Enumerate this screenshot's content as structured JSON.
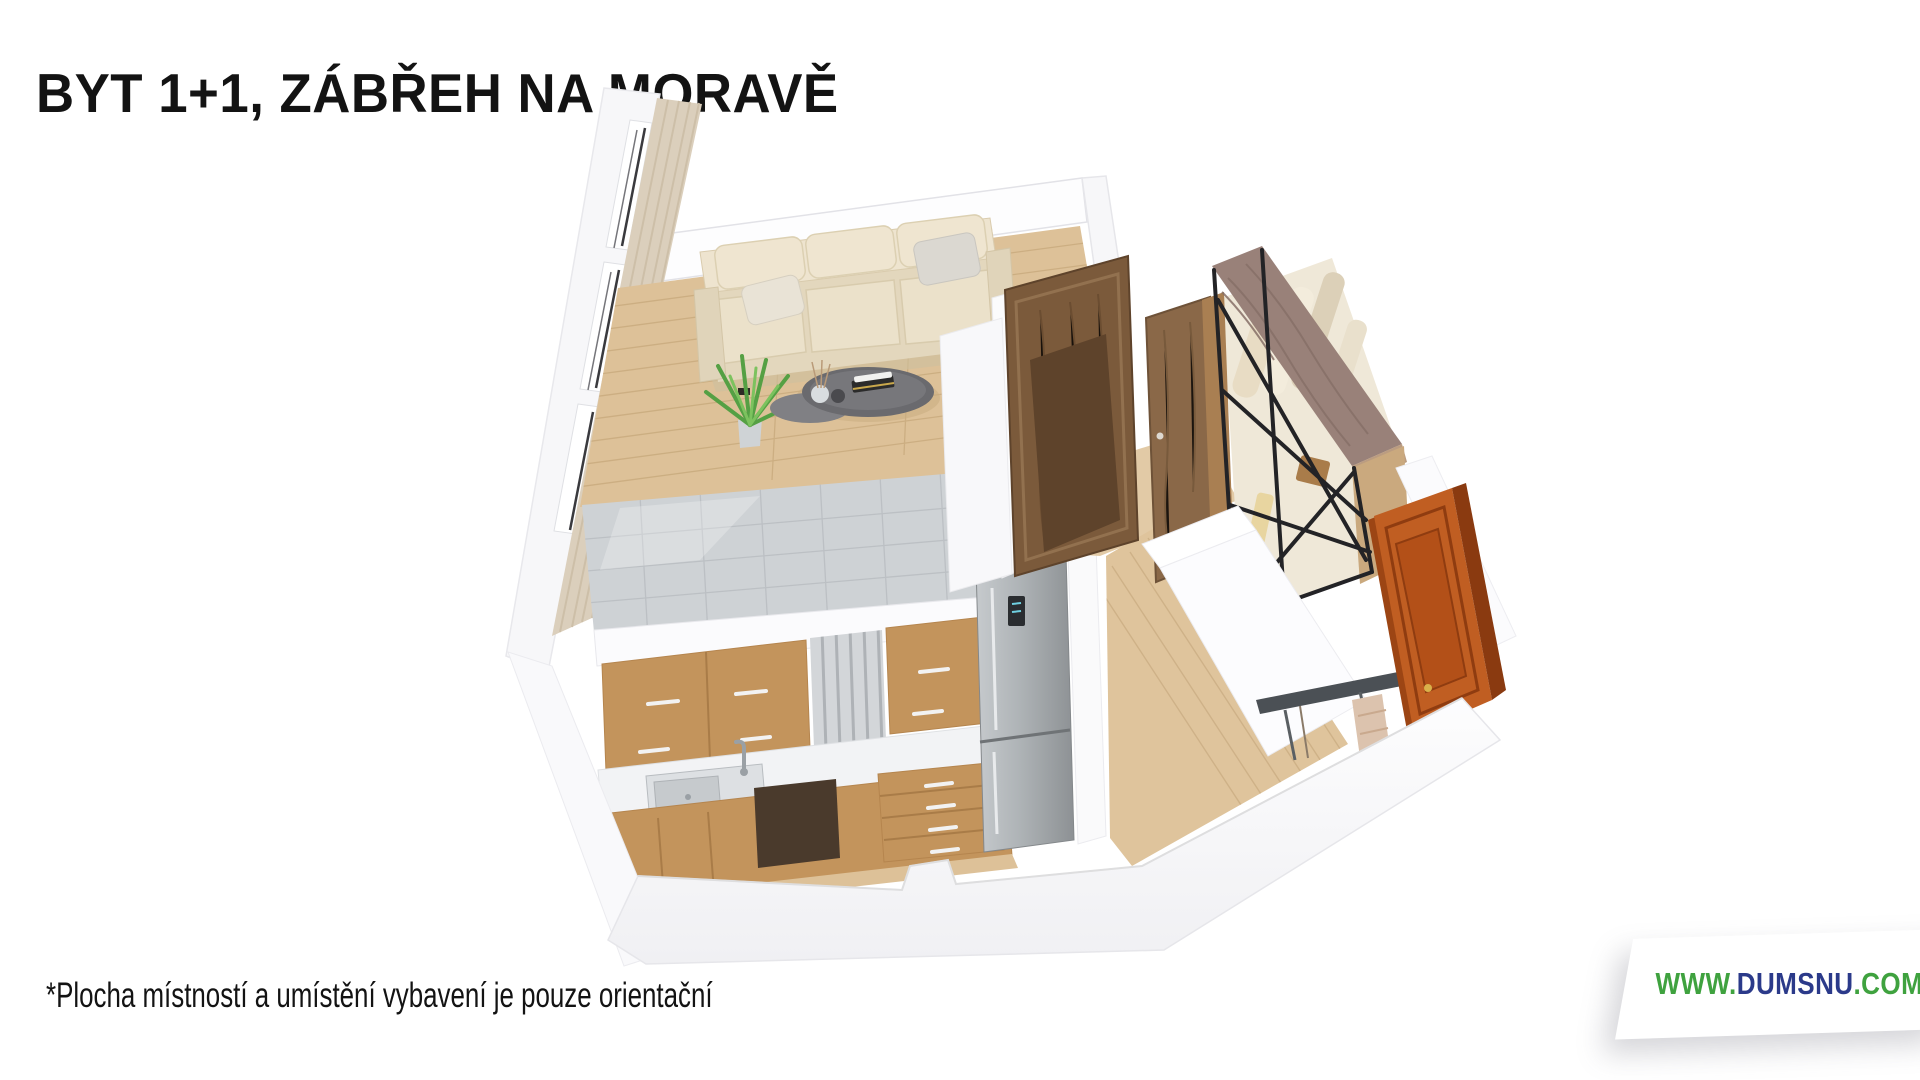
{
  "page": {
    "width": 1920,
    "height": 1080,
    "background": "#ffffff"
  },
  "header": {
    "title": "BYT 1+1, ZÁBŘEH NA MORAVĚ"
  },
  "footer": {
    "disclaimer": "*Plocha místností a umístění vybavení je pouze orientační"
  },
  "watermark": {
    "prefix": "WWW.",
    "name": "DUMSNU",
    "tld": ".COM"
  },
  "floorplan": {
    "type": "3d-rendered-floor-plan",
    "rooms": [
      {
        "name": "living-room",
        "objects": [
          "window-wall-with-curtains",
          "cream-sofa",
          "throw-pillows",
          "coffee-table",
          "potted-plant",
          "wood-floor"
        ]
      },
      {
        "name": "kitchen",
        "objects": [
          "grey-tile-backsplash",
          "upper-wood-cabinets",
          "slat-panel",
          "white-countertop",
          "steel-sink-with-faucet",
          "lower-wood-cabinets",
          "dark-appliance",
          "drawer-unit",
          "stainless-fridge"
        ]
      },
      {
        "name": "hallway",
        "objects": [
          "wood-plank-floor",
          "open-wardrobe-black-frame",
          "hanging-clothes",
          "coat-rack",
          "hanging-towel",
          "orange-entrance-door"
        ]
      },
      {
        "name": "bathroom-core",
        "objects": [
          "dark-wood-doors",
          "white-partition-walls"
        ]
      }
    ]
  },
  "colors": {
    "page_white": "#ffffff",
    "text_black": "#131313",
    "logo_green": "#3fa23f",
    "logo_navy": "#2b3a8a",
    "wall_white": "#fdfdfe",
    "wall_edge": "#e6e6ea",
    "wall_shadow": "#f0f0f3",
    "wood_floor": "#ddc198",
    "wood_plank_line": "#c9ab7e",
    "sofa_cream": "#eae0c8",
    "sofa_shade": "#dccfae",
    "pillow_grey": "#dbd8d1",
    "tile_grey": "#ced2d5",
    "tile_grout": "#bcc0c4",
    "cabinet_wood": "#c3945c",
    "cabinet_dark": "#4a3a2c",
    "counter_white": "#f2f3f5",
    "steel_light": "#c2c6c9",
    "steel_dark": "#8d9194",
    "door_wood_dark": "#7b5a3b",
    "door_wood_mid": "#8a6848",
    "door_orange": "#c05e22",
    "door_orange_dark": "#8a3a10",
    "wardrobe_top": "#998179",
    "metal_frame": "#232326",
    "plant_green": "#55a044",
    "plant_green_light": "#7cc25e",
    "table_dark": "#6a6a6e",
    "curtain_beige": "#dbcfbc",
    "rack_dark": "#4b5055",
    "towel": "#dcc3ae"
  }
}
